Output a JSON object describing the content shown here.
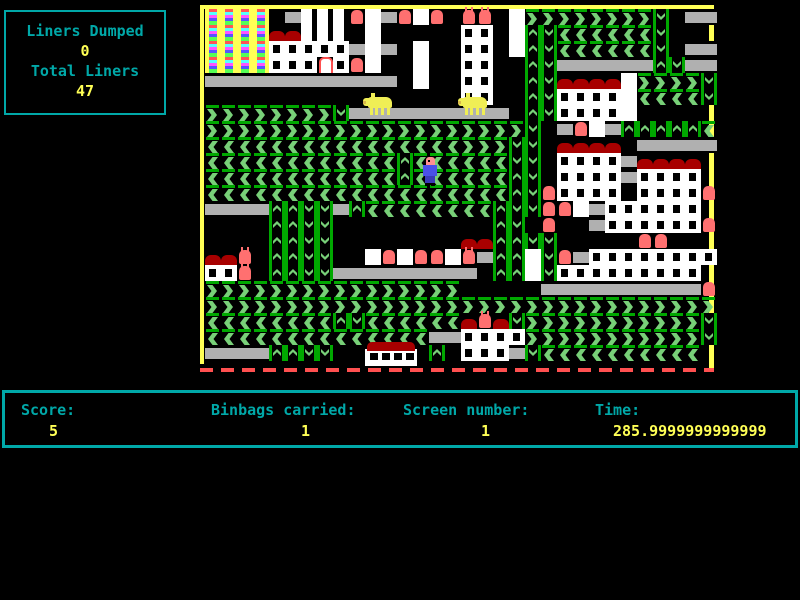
{
  "info_box": {
    "line1": "Liners Dumped",
    "value1": "0",
    "line2": "Total Liners",
    "value2": "47"
  },
  "status_bar": {
    "fields": [
      {
        "label": "Score:",
        "value": "5",
        "label_x": 16,
        "value_x": 44,
        "value_align": "left"
      },
      {
        "label": "Binbags carried:",
        "value": "1",
        "label_x": 206,
        "value_x": 296,
        "value_align": "left"
      },
      {
        "label": "Screen number:",
        "value": "1",
        "label_x": 398,
        "value_x": 476,
        "value_align": "left"
      },
      {
        "label": "Time:",
        "value": "285.9999999999999",
        "label_x": 590,
        "value_x": 780,
        "value_align": "right"
      }
    ]
  },
  "colors": {
    "background": "#000000",
    "border_yellow": "#ffff55",
    "text_cyan": "#00a8a8",
    "text_yellow": "#ffff55",
    "road_gray": "#b0b0b0",
    "conveyor_green_dark": "#00a800",
    "chevron_green_light": "#78d078",
    "building_white": "#ffffff",
    "roof_red": "#a80000",
    "bin_red": "#ff7070",
    "pig_yellow": "#f0ee55",
    "player_shirt_blue": "#4a50e8",
    "player_skin_pink": "#ff9090",
    "bottom_border_red": "#ff5050"
  },
  "playfield": {
    "x": 200,
    "y": 5,
    "width": 514,
    "height": 370,
    "tile_size": 16,
    "legend": {
      ".": "empty",
      "#": "road",
      ">": "conveyor-right",
      "<": "conveyor-left",
      "^": "conveyor-up",
      "v": "conveyor-down",
      "W": "building-wall",
      "o": "building-window",
      "R": "red-roof",
      "B": "binbag",
      "H": "binbag-handles",
      "L": "white-liner-bin",
      "F": "rainbow-flat",
      "P": "white-pillars"
    },
    "map_rows": [
      "FFFF.#PPPBW#BWB.HH.W>>>>>>>>v.##",
      "FFFFRRPPP.W.....oo.W^v<<<<<<v...",
      "FFFFooooo#W#.W..oo.W^v<<<<<<v.##",
      "FFFFoooLoBW..W..oo..^v######^v##",
      "############.W..oo..^vRRRRW>>>>v",
      "................oo..^vooooW<<<<v",
      ">>>>>>>>v##########.^vooooW.....",
      ">>>>>>>>>>>>>>>>>>>>v.#BW#^^^^^<",
      "<<<<<<<<<<<<<<<<>>>vv.RRRR.#####",
      "<<<<<<<<<<<<^<<<<<<vv.oooo#RRRR.",
      "<<<<<<<<<<<<^<<<<<<^v.oooo#oooo.",
      "<<<<<<<<<<<<<<<<<<<^vBoooo.ooooB",
      "####^^vv#^<<<<<<<<^vvBBW#oooooo.",
      "....^^vv..........^v.B..#ooooooB",
      "....^^vv........RR^^vv.....BB...",
      "RRH.^^vv..WBWBBWH#^^WvB#oooooooo",
      "ooH.^^vv#########.^^Wvooooooooo.",
      ">>>>>>>>>>>>>>>>.....##########B",
      ">>>>>>>>>>>>>>>>>>>>>>>>>>>>>>>>",
      "<<<<<<<<^v<<<<<<RHRv>>>>>>>>>>>v",
      "<<<<<<<<<<<<<<##oooo>>>>>>>>>>>v",
      "####^^vv......^.ooo#v<<<<<<<<<<.",
      "................................"
    ],
    "sprites": [
      {
        "type": "player",
        "x": 223,
        "y": 152,
        "w": 15,
        "h": 29
      },
      {
        "type": "pig",
        "x": 163,
        "y": 87,
        "w": 30,
        "h": 23
      },
      {
        "type": "pig",
        "x": 258,
        "y": 87,
        "w": 30,
        "h": 23
      },
      {
        "type": "bus",
        "x": 165,
        "y": 337,
        "w": 52,
        "h": 26
      }
    ]
  }
}
